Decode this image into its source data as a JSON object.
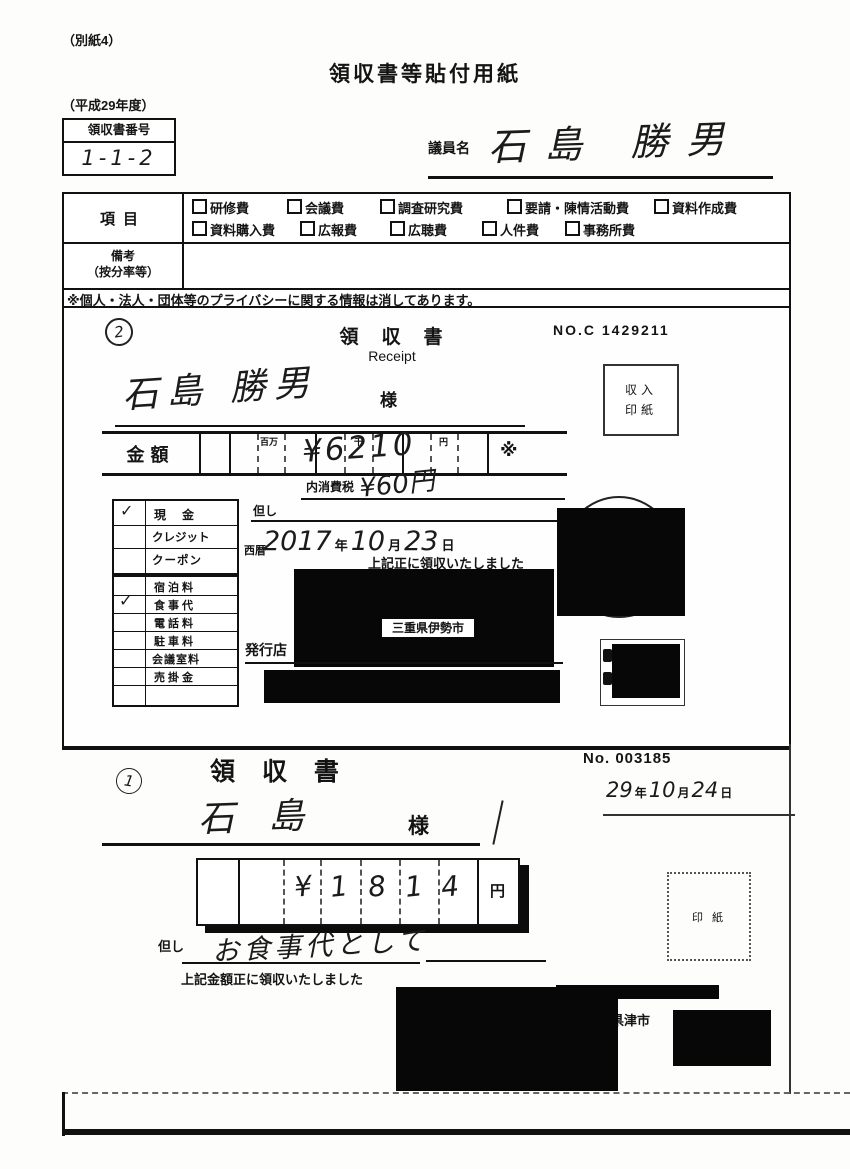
{
  "check_mark": "✓",
  "page": {
    "corner_note": "（別紙4）",
    "title": "領収書等貼付用紙",
    "fiscal_year": "（平成29年度）",
    "receipt_no_label": "領収書番号",
    "receipt_no_value": "1-1-2",
    "member_label": "議員名",
    "member_name": "石島 勝男",
    "privacy_note": "※個人・法人・団体等のプライバシーに関する情報は消してあります。"
  },
  "category": {
    "label": "項目",
    "row1": [
      "研修費",
      "会議費",
      "調査研究費",
      "要請・陳情活動費",
      "資料作成費"
    ],
    "row2": [
      "資料購入費",
      "広報費",
      "広聴費",
      "人件費",
      "事務所費"
    ],
    "remarks_label1": "備考",
    "remarks_label2": "（按分率等）"
  },
  "receipt2": {
    "index": "2",
    "title": "領　収　書",
    "subtitle": "Receipt",
    "no": "NO.C 1429211",
    "revenue_stamp_line1": "収入",
    "revenue_stamp_line2": "印紙",
    "payee": "石島 勝男",
    "honorific": "様",
    "amount_label": "金額",
    "amount_value": "¥6210",
    "marker_million": "百万",
    "marker_thousand": "千",
    "marker_yen": "円",
    "asterisk": "※",
    "tax_label": "内消費税",
    "tax_value": "¥60円",
    "proviso_label": "但し",
    "era_label": "西暦",
    "date_parts": [
      "2017",
      "年",
      "10",
      "月",
      "23",
      "日"
    ],
    "received_note": "上記正に領収いたしました",
    "issuer_label": "発行店",
    "issuer_visible_text": "三重県伊勢市",
    "pay_methods": [
      {
        "label": "現　金",
        "checked": true
      },
      {
        "label": "クレジット",
        "checked": false
      },
      {
        "label": "クーポン",
        "checked": false
      }
    ],
    "expense_types": [
      {
        "label": "宿泊料",
        "checked": false
      },
      {
        "label": "食事代",
        "checked": true
      },
      {
        "label": "電話料",
        "checked": false
      },
      {
        "label": "駐車料",
        "checked": false
      },
      {
        "label": "会議室料",
        "checked": false
      },
      {
        "label": "売掛金",
        "checked": false
      }
    ]
  },
  "receipt1": {
    "index": "1",
    "title": "領 収 書",
    "no": "No. 003185",
    "date_parts": [
      "29",
      "年",
      "10",
      "月",
      "24",
      "日"
    ],
    "payee": "石島",
    "honorific": "様",
    "amount_digits": [
      "¥",
      "1",
      "8",
      "1",
      "4"
    ],
    "yen_label": "円",
    "revenue_stamp": "印 紙",
    "proviso_label": "但し",
    "purpose": "お食事代として",
    "received_note": "上記金額正に領収いたしました",
    "issuer_visible_text": "重県津市"
  }
}
